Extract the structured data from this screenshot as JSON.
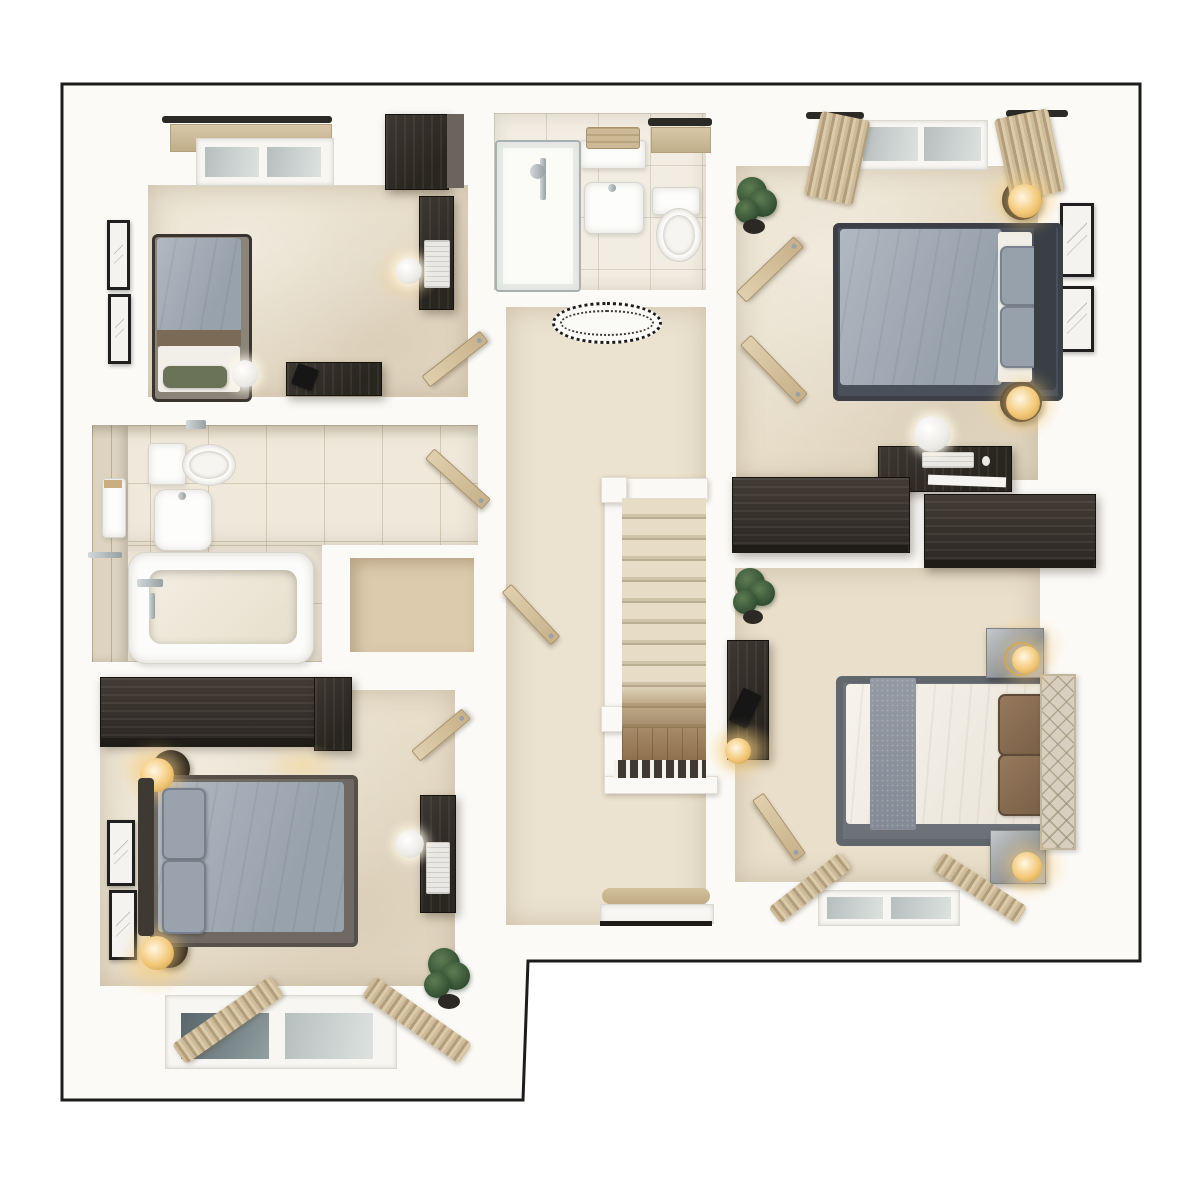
{
  "meta": {
    "kind": "3d-floor-plan-top-down-render",
    "storey": "upper-floor-landing-level",
    "visible_text": "none",
    "canvas_size": "1200x1200"
  },
  "palette": {
    "page_background": "#ffffff",
    "outline": "#1c1c1c",
    "wall_white": "#fbfaf7",
    "carpet_beige": "#e8deca",
    "bathroom_tile": "#f0e9db",
    "dark_wood_furniture": "#2f2b25",
    "light_wood_door": "#d3bf9c",
    "gray_bedding": "#a6afb9",
    "white_bedding": "#f2efe7",
    "brown_pillows": "#8a7157",
    "lamp_glow": "#f3c877",
    "plant_green": "#3e5c3c",
    "glass": "#c3cbca"
  },
  "outline_points": "62,84 1140,84 1140,961 528,961 523,1100 62,1100",
  "counts": {
    "bedrooms": 4,
    "bathrooms": 2,
    "storage_cupboards": 1,
    "door_leaves": 7,
    "windows": 6,
    "plants": 3,
    "staircase_treads": 11
  },
  "rooms": [
    {
      "name": "en-suite shower room (top centre)",
      "furniture": [
        "shower-enclosure",
        "shower-mixer",
        "wash-basin",
        "toilet",
        "towel-shelf",
        "window-with-blind"
      ]
    },
    {
      "name": "single bedroom (top left)",
      "furniture": [
        "single-bed-gray-duvet",
        "green-pillow",
        "wardrobe",
        "desk-with-laptop",
        "desk-lamp-globe",
        "sideboard-desk",
        "black-desk-lamp",
        "candle-lamp",
        "two-wall-pictures",
        "window-with-blind",
        "open-door"
      ]
    },
    {
      "name": "family bathroom (left middle)",
      "furniture": [
        "bathtub-with-taps",
        "toilet",
        "pedestal-basin",
        "wall-cabinet",
        "towel-rail",
        "toilet-roll-holder",
        "open-door"
      ]
    },
    {
      "name": "airing cupboard (centre left)",
      "furniture": [
        "open-door-into-landing"
      ]
    },
    {
      "name": "landing hallway with staircase (centre)",
      "furniture": [
        "staircase-11-treads",
        "banister-rails",
        "spindle-balustrade",
        "oval-ceiling-spotlight",
        "window-bench-with-cushion"
      ]
    },
    {
      "name": "double bedroom (top right)",
      "furniture": [
        "double-bed-gray-duvet",
        "dark-headboard",
        "two-gray-pillows",
        "two-bedside-lamps",
        "two-wall-pictures",
        "window-with-curtains",
        "plant",
        "desk-with-keyboard",
        "desk-sphere-lamp",
        "low-wardrobe",
        "open-entry-door",
        "open-ensuite-door"
      ]
    },
    {
      "name": "double bedroom (bottom right)",
      "furniture": [
        "double-bed-white-duvet",
        "gray-bed-runner",
        "cream-lattice-headboard",
        "four-brown-pillows",
        "two-mirrored-nightstands",
        "two-gold-globe-lamps",
        "desk-with-black-lamp",
        "gold-desk-lamp",
        "low-wardrobe",
        "plant",
        "window-with-curtains",
        "open-door"
      ]
    },
    {
      "name": "double bedroom (bottom left)",
      "furniture": [
        "double-bed-gray-duvet",
        "dark-headboard",
        "two-gray-pillows",
        "two-bedside-globe-lamps",
        "long-wardrobe",
        "two-wall-pictures",
        "desk-with-keyboard",
        "desk-sphere-lamp",
        "plant",
        "window-with-curtains",
        "open-door"
      ]
    }
  ]
}
